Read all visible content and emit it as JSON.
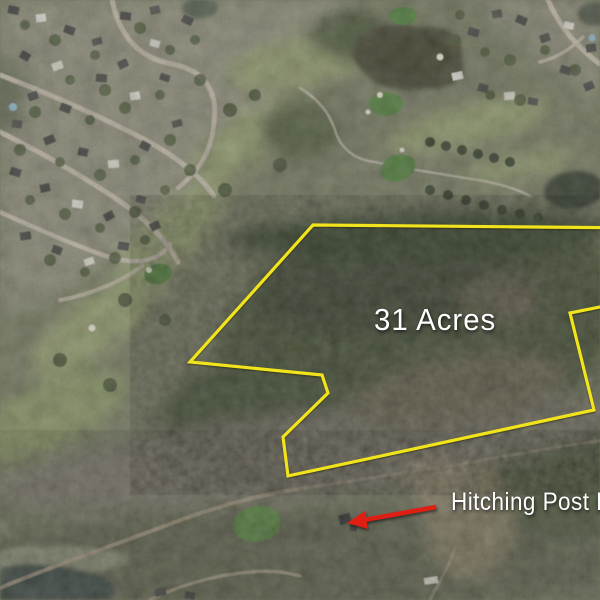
{
  "map": {
    "annotations": {
      "acreage_label": "31 Acres",
      "street_label": "Hitching Post L",
      "boundary_color": "#f2e41c",
      "arrow_color": "#e01f14",
      "label_color": "#ffffff"
    }
  }
}
